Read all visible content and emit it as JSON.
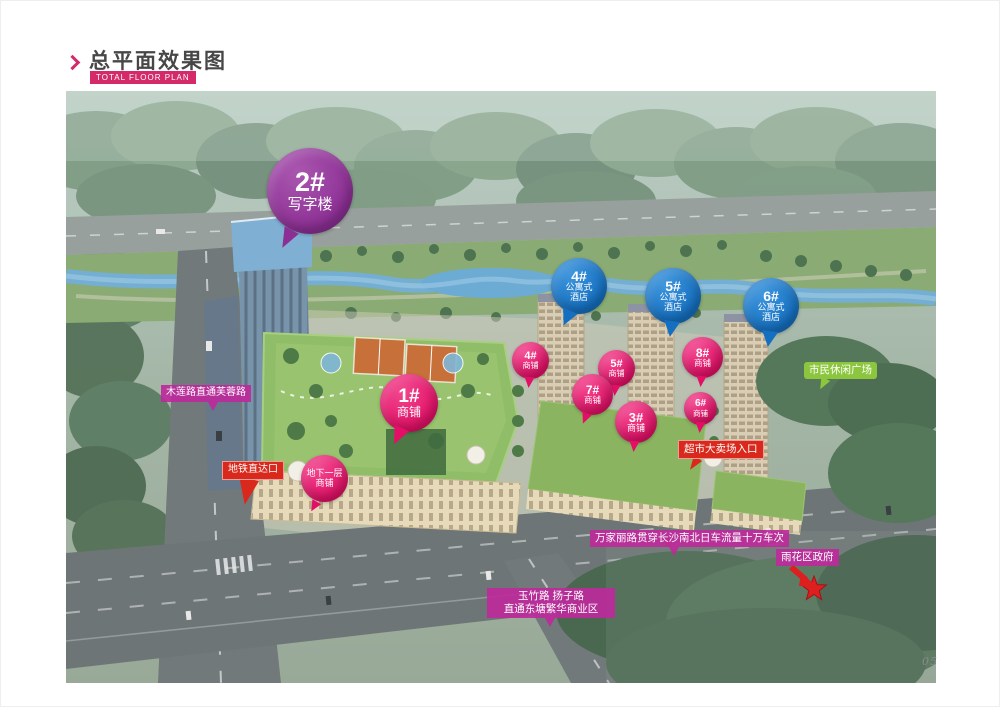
{
  "header": {
    "title": "总平面效果图",
    "subtitle": "TOTAL FLOOR PLAN"
  },
  "page_number": "05",
  "markers": {
    "office2": {
      "num": "2#",
      "label": "写字楼"
    },
    "hotel4": {
      "num": "4#",
      "line1": "公寓式",
      "line2": "酒店"
    },
    "hotel5": {
      "num": "5#",
      "line1": "公寓式",
      "line2": "酒店"
    },
    "hotel6": {
      "num": "6#",
      "line1": "公寓式",
      "line2": "酒店"
    },
    "shop1": {
      "num": "1#",
      "label": "商铺"
    },
    "shop3": {
      "num": "3#",
      "label": "商铺"
    },
    "shop4": {
      "num": "4#",
      "label": "商铺"
    },
    "shop5": {
      "num": "5#",
      "label": "商铺"
    },
    "shop6": {
      "num": "6#",
      "label": "商铺"
    },
    "shop7": {
      "num": "7#",
      "label": "商铺"
    },
    "shop8": {
      "num": "8#",
      "label": "商铺"
    },
    "basement": {
      "line1": "地下一层",
      "line2": "商铺"
    }
  },
  "annotations": {
    "metro": "地铁直达口",
    "supermarket": "超市大卖场入口",
    "mulian_road": "木莲路直通芙蓉路",
    "civic_plaza": "市民休闲广场",
    "wanjiali_road": "万家丽路贯穿长沙南北日车流量十万车次",
    "district_gov": "雨花区政府",
    "south_roads_line1": "玉竹路  扬子路",
    "south_roads_line2": "直通东塘繁华商业区"
  },
  "colors": {
    "accent_magenta": "#d42a6a",
    "balloon_purple": "#8c2f94",
    "balloon_blue": "#146fc0",
    "balloon_pink": "#e30f66",
    "tag_red": "#d9291c",
    "tag_magenta": "#bd2a9b",
    "tag_green": "#8cc63e",
    "star_red": "#dd1f1f"
  }
}
